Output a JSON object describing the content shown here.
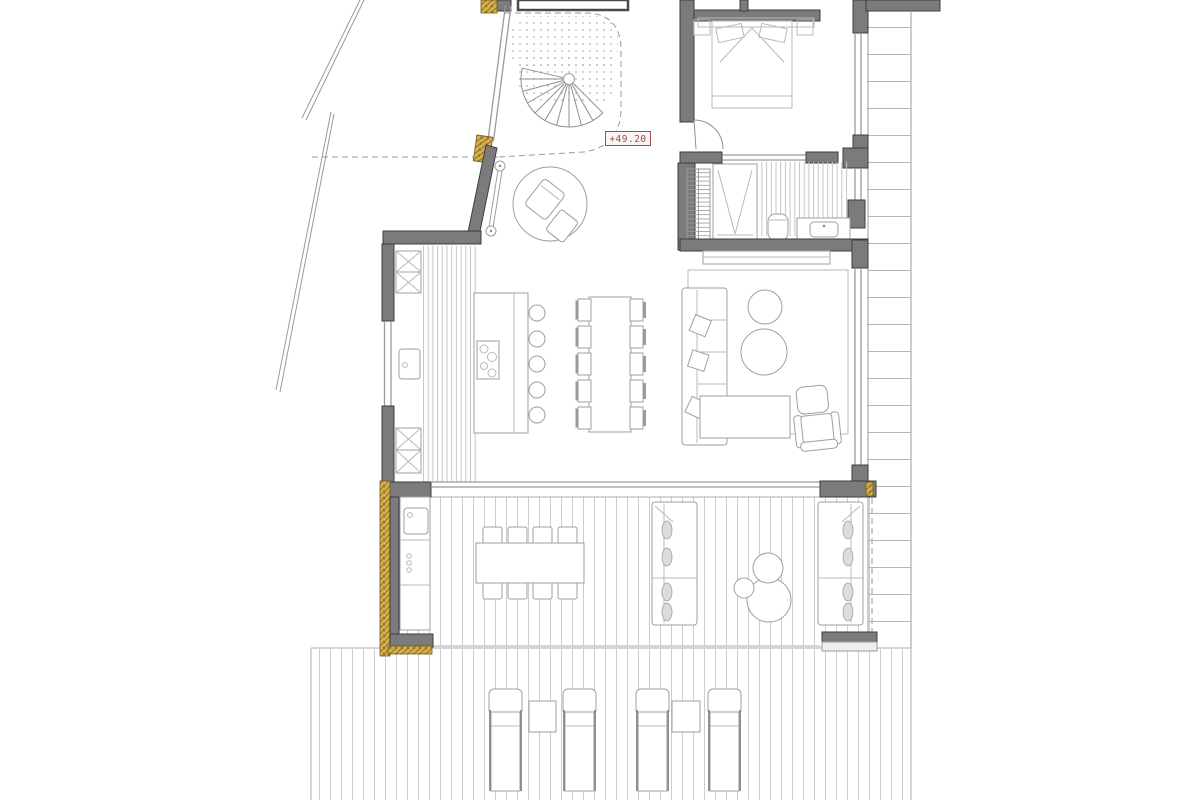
{
  "plan": {
    "elevation_label": "+49.20",
    "colors": {
      "wall": "#7b7b7b",
      "wall_stroke": "#3e3e3e",
      "line": "#9a9a9a",
      "furniture": "#9f9f9f",
      "furniture_light": "#b9b9b9",
      "deck_line": "#cdcdcd",
      "tile_line": "#c6c6c6",
      "gold": "#d8b14d",
      "gold_stroke": "#6f5c1d",
      "gold_hatch": "#8a6f26",
      "label_red": "#a34a4a",
      "label_bg": "#fbf4f4",
      "bg": "#ffffff",
      "cushion": "#dcdcdc"
    }
  }
}
